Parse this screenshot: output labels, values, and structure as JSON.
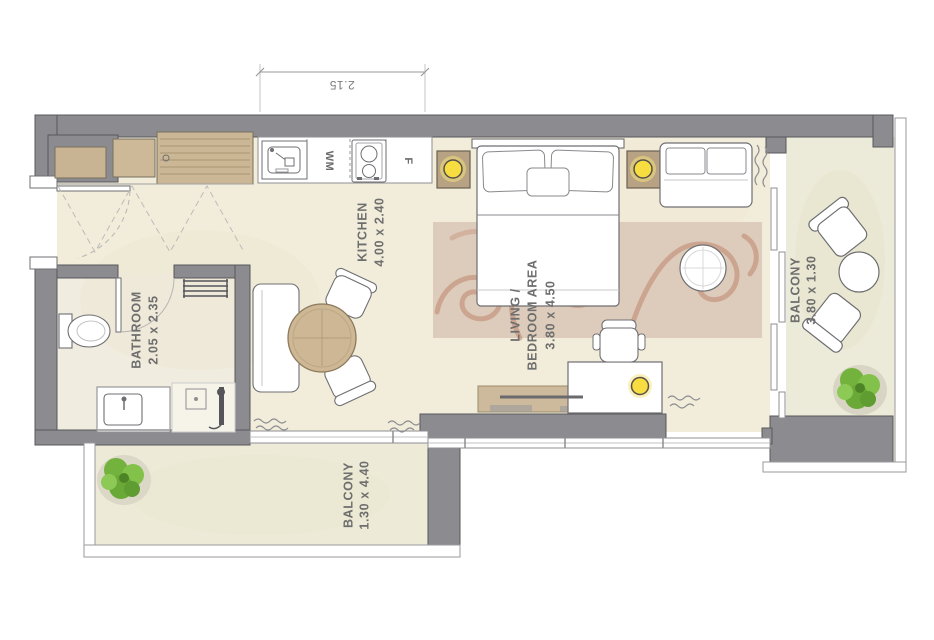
{
  "dimension": {
    "top_width": "2.15"
  },
  "rooms": {
    "kitchen": {
      "label": "KITCHEN",
      "size": "4.00 x 2.40"
    },
    "living_bedroom": {
      "label_line1": "LIVING /",
      "label_line2": "BEDROOM AREA",
      "size": "3.80 x 4.50"
    },
    "bathroom": {
      "label": "BATHROOM",
      "size": "2.05 x 2.35"
    },
    "balcony_right": {
      "label": "BALCONY",
      "size": "3.80 x 1.30"
    },
    "balcony_bottom": {
      "label": "BALCONY",
      "size": "1.30 x 4.40"
    }
  },
  "appliances": {
    "washing_machine_label": "WM",
    "fridge_label": "F"
  },
  "colors": {
    "wall": "#8c8c90",
    "floor": "#f2edda",
    "rug": "#ddccbb",
    "rug_swirl": "#bf8770",
    "lamp_yellow": "#f7dd40",
    "plant_green": "#74b23e",
    "wood": "#cdb795"
  }
}
